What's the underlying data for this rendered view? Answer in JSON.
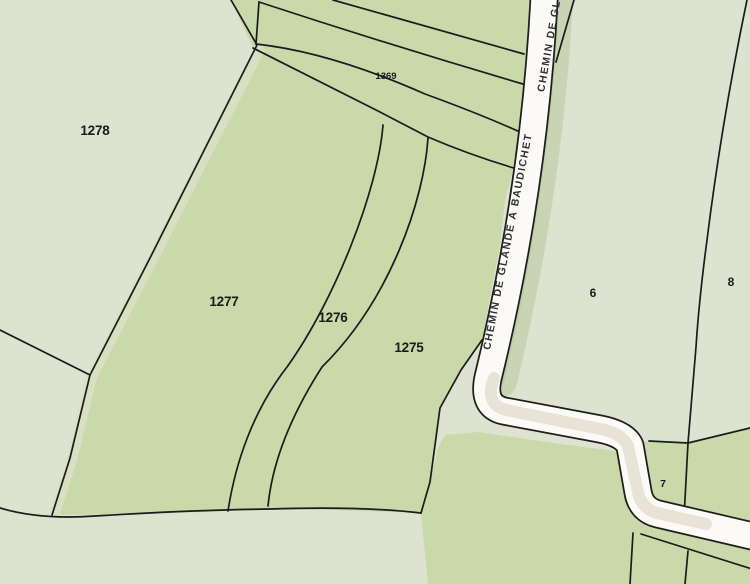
{
  "map": {
    "parcels": {
      "p1278": "1278",
      "p1277": "1277",
      "p1276": "1276",
      "p1275": "1275",
      "p1369": "1369",
      "p6": "6",
      "p8": "8",
      "p7": "7"
    },
    "roads": {
      "main_label": "CHEMIN DE GLANDE À BAUDICHET",
      "secondary_label": "CHEMIN DE GLA"
    },
    "colors": {
      "field_green": "#c9d9aa",
      "pale_green": "#dde3d0",
      "verge_pale": "#d9e0c3",
      "road_fill": "#fbfaf6",
      "road_casing": "#1e1e1e",
      "boundary_line": "#1b1b1b",
      "road_shadow_green": "#a9be86",
      "road_shadow_tan": "#d7cfbc",
      "label_color": "#1a1a1a",
      "road_label_color": "#303030"
    }
  }
}
